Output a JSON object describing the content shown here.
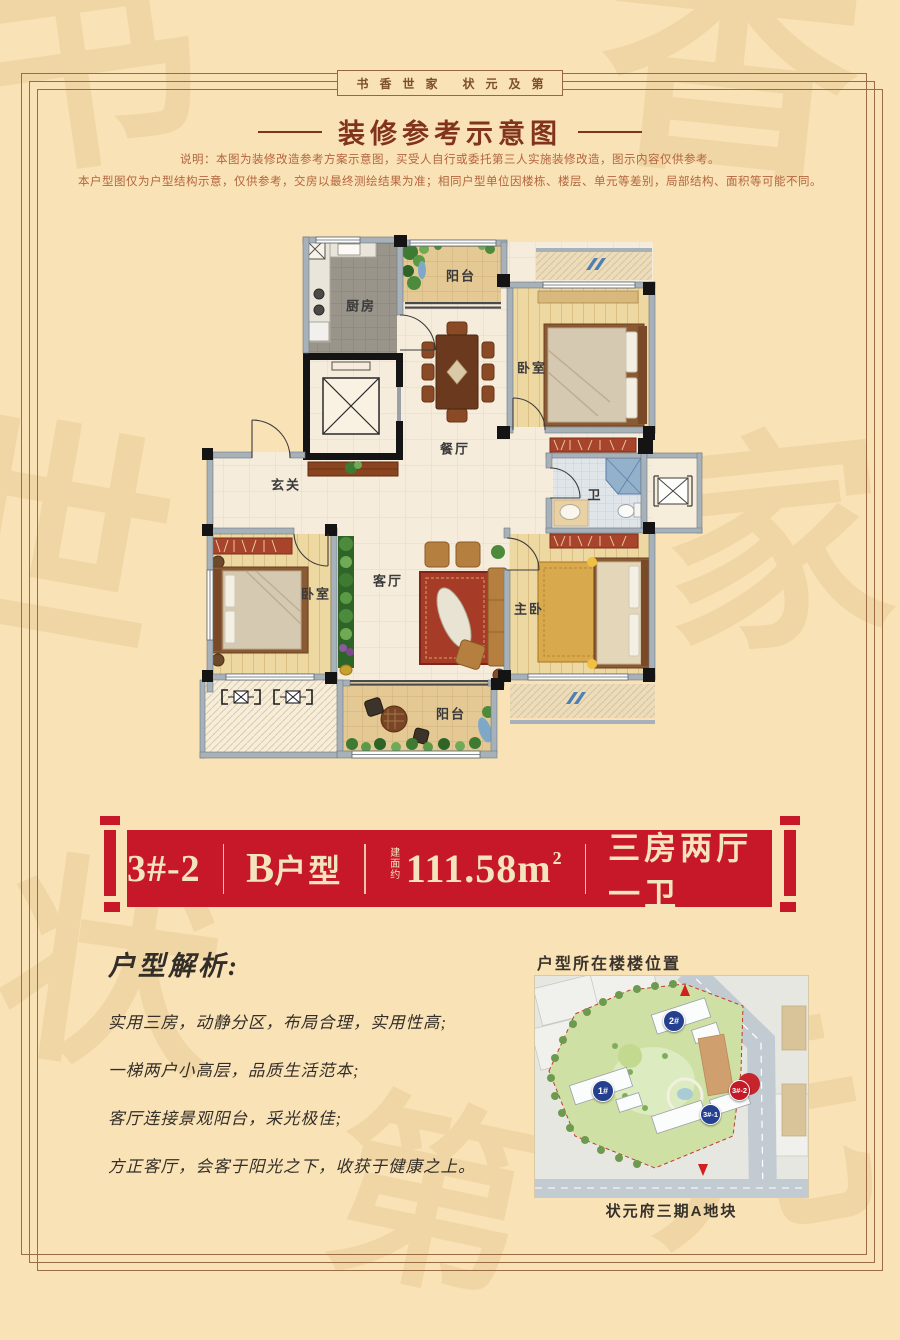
{
  "colors": {
    "page_bg": "#f9e2b6",
    "frame": "#9b6b43",
    "banner_red": "#c7182a",
    "banner_text": "#f3e4bd",
    "badge_navy": "#24408e",
    "badge_red": "#c41a28"
  },
  "watermark": [
    "书",
    "香",
    "世",
    "家",
    "状",
    "元",
    "第"
  ],
  "header": {
    "motto": "书香世家 状元及第",
    "title": "装修参考示意图",
    "disclaimer_line1": "说明：本图为装修改造参考方案示意图，买受人自行或委托第三人实施装修改造，图示内容仅供参考。",
    "disclaimer_line2": "本户型图仅为户型结构示意，仅供参考，交房以最终测绘结果为准；相同户型单位因楼栋、楼层、单元等差别，局部结构、面积等可能不同。"
  },
  "floorplan": {
    "rooms": {
      "kitchen": "厨房",
      "balcony_top": "阳台",
      "bedroom_top": "卧室",
      "dining": "餐厅",
      "foyer": "玄关",
      "bath": "卫",
      "bedroom_left": "卧室",
      "living": "客厅",
      "master": "主卧",
      "balcony_bottom": "阳台"
    }
  },
  "banner": {
    "unit": "3#-2",
    "type_letter": "B",
    "type_suffix": "户型",
    "area_prefix": "建面约",
    "area_value": "111.58m",
    "area_sup": "2",
    "layout": "三房两厅一卫"
  },
  "analysis": {
    "title": "户型解析:",
    "points": [
      "实用三房，动静分区，布局合理，实用性高;",
      "一梯两户小高层，品质生活范本;",
      "客厅连接景观阳台，采光极佳;",
      "方正客厅，会客于阳光之下，收获于健康之上。"
    ]
  },
  "location": {
    "title": "户型所在楼楼位置",
    "caption": "状元府三期A地块",
    "buildings": [
      {
        "label": "1#"
      },
      {
        "label": "2#"
      },
      {
        "label": "3#-1"
      },
      {
        "label": "3#-2"
      }
    ]
  }
}
